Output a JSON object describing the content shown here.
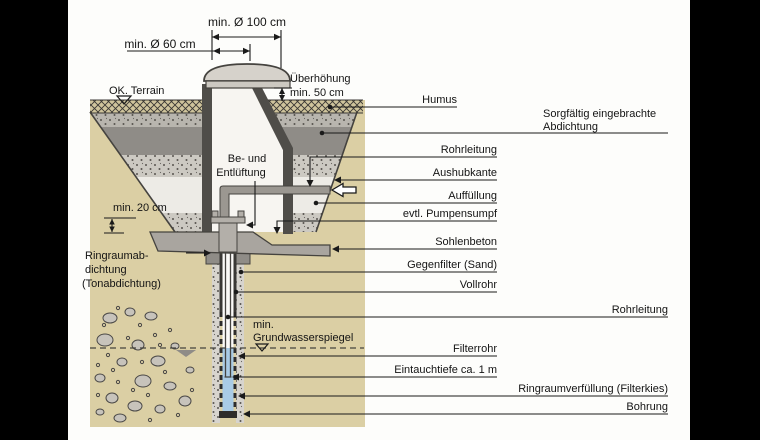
{
  "diagram": {
    "title_context": "Grundwasserbrunnen Schacht Querschnitt",
    "dimensions": {
      "dia100": "min. Ø 100 cm",
      "dia60": "min. Ø 60 cm",
      "overheight_line1": "Überhöhung",
      "overheight_line2": "min. 50 cm",
      "min20": "min. 20 cm"
    },
    "left_labels": {
      "terrain": "OK. Terrain",
      "vent_line1": "Be- und",
      "vent_line2": "Entlüftung",
      "ringseal_line1": "Ringraumab-",
      "ringseal_line2": "dichtung",
      "ringseal_line3": "(Tonabdichtung)",
      "groundwater_line1": "min.",
      "groundwater_line2": "Grundwasserspiegel"
    },
    "right_labels": {
      "humus": "Humus",
      "sealing_line1": "Sorgfältig eingebrachte",
      "sealing_line2": "Abdichtung",
      "pipe1": "Rohrleitung",
      "excavation_edge": "Aushubkante",
      "backfill": "Auffüllung",
      "pump_sump": "evtl. Pumpensumpf",
      "base_concrete": "Sohlenbeton",
      "counter_filter": "Gegenfilter (Sand)",
      "solid_pipe": "Vollrohr",
      "pipe2": "Rohrleitung",
      "filter_pipe": "Filterrohr",
      "immersion_depth": "Eintauchtiefe ca. 1 m",
      "annulus_fill": "Ringraumverfüllung (Filterkies)",
      "borehole": "Bohrung"
    },
    "colors": {
      "soil_tan": "#dbcfa4",
      "hatch_tan": "#cfc49c",
      "water_blue": "#a9cbe5",
      "wall_gray": "#4f4d49",
      "sealing_band_gray": "#8f8c87",
      "concrete_gray": "#a9a59f",
      "speckle_band": "#ccc9c2",
      "line_black": "#1a1a1a"
    }
  }
}
